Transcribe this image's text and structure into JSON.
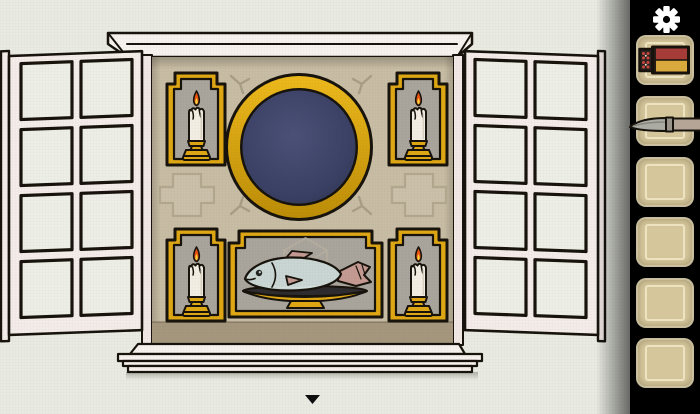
{
  "palette": {
    "wall": "#e9ebe3",
    "alcove": "#c8bda4",
    "alcoveBand": "#a5977e",
    "gold": "#dfa713",
    "outline": "#17130c",
    "navyEdge": "#2e3452",
    "niche": "#a9a59d",
    "frameWhite": "#f7f2ee",
    "jambPink": "#f1e8e5",
    "shutter": "#f3ece9",
    "pane": "#edefe7",
    "crossFill": "#cbc1aa",
    "crossLine": "#b2a88f",
    "mark": "#a89e87",
    "cubeLine": "#b7ae9f",
    "wax": "#f3eee3",
    "flameOuter": "#ee5310",
    "flameInner": "#fbd23a",
    "fishBody": "#c9d6d3",
    "fishFin": "#c49a92",
    "plateDark": "#2e2b2f",
    "sidebar": "#000000",
    "slot": "#d5c69c",
    "slotLine": "#eee3c0",
    "matchRed": "#a63c38",
    "matchYellow": "#d9a93e",
    "matchDrawer": "#2c2320",
    "blade": "#abaaa3",
    "handle": "#b4a596",
    "arrow": "#0d0d0d",
    "gearWhite": "#ffffff"
  },
  "scene": {
    "objects": {
      "mirror": "dark round mirror",
      "candle_top_left": "lit candle",
      "candle_top_right": "lit candle",
      "candle_bottom_left": "lit candle",
      "candle_bottom_right": "lit candle",
      "fish_plate": "fish on serving plate",
      "left_shutter": "open window shutter",
      "right_shutter": "open window shutter"
    },
    "nav_arrow": "down"
  },
  "sidebar": {
    "settings": "gear",
    "slots": [
      {
        "index": 1,
        "item": "matchbox"
      },
      {
        "index": 2,
        "item": "knife"
      },
      {
        "index": 3,
        "item": ""
      },
      {
        "index": 4,
        "item": ""
      },
      {
        "index": 5,
        "item": ""
      },
      {
        "index": 6,
        "item": ""
      }
    ]
  }
}
